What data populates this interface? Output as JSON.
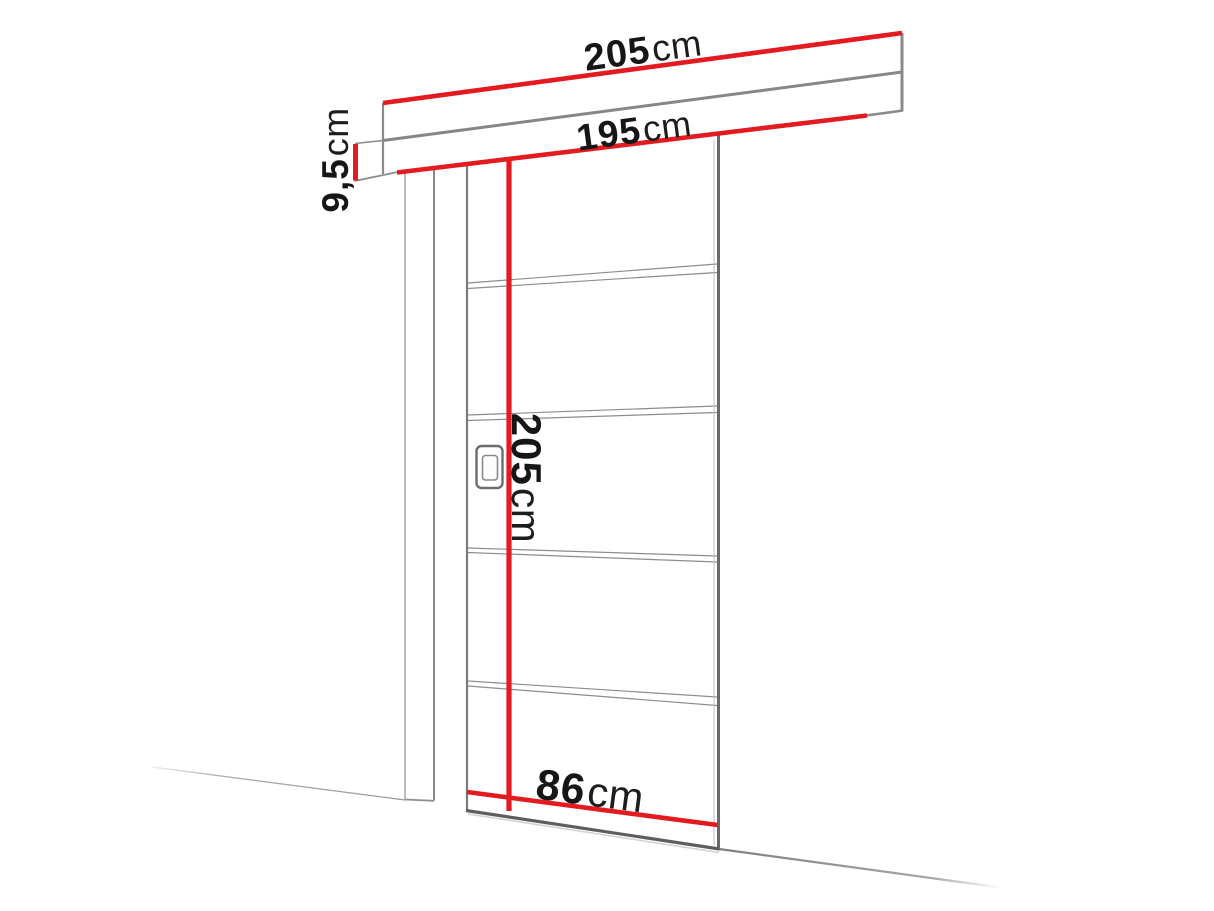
{
  "dimensions": {
    "rail_length": {
      "value": "205",
      "unit": "cm"
    },
    "clear_width": {
      "value": "195",
      "unit": "cm"
    },
    "rail_height": {
      "value": "9,5",
      "unit": "cm"
    },
    "door_height": {
      "value": "205",
      "unit": "cm"
    },
    "door_width": {
      "value": "86",
      "unit": "cm"
    }
  },
  "colors": {
    "dimension_line": "#e31b20",
    "outline": "#8a8a8a",
    "outline_dark": "#696969",
    "outline_faint": "#b5b5b5",
    "label_text": "#161616",
    "background": "#ffffff"
  }
}
